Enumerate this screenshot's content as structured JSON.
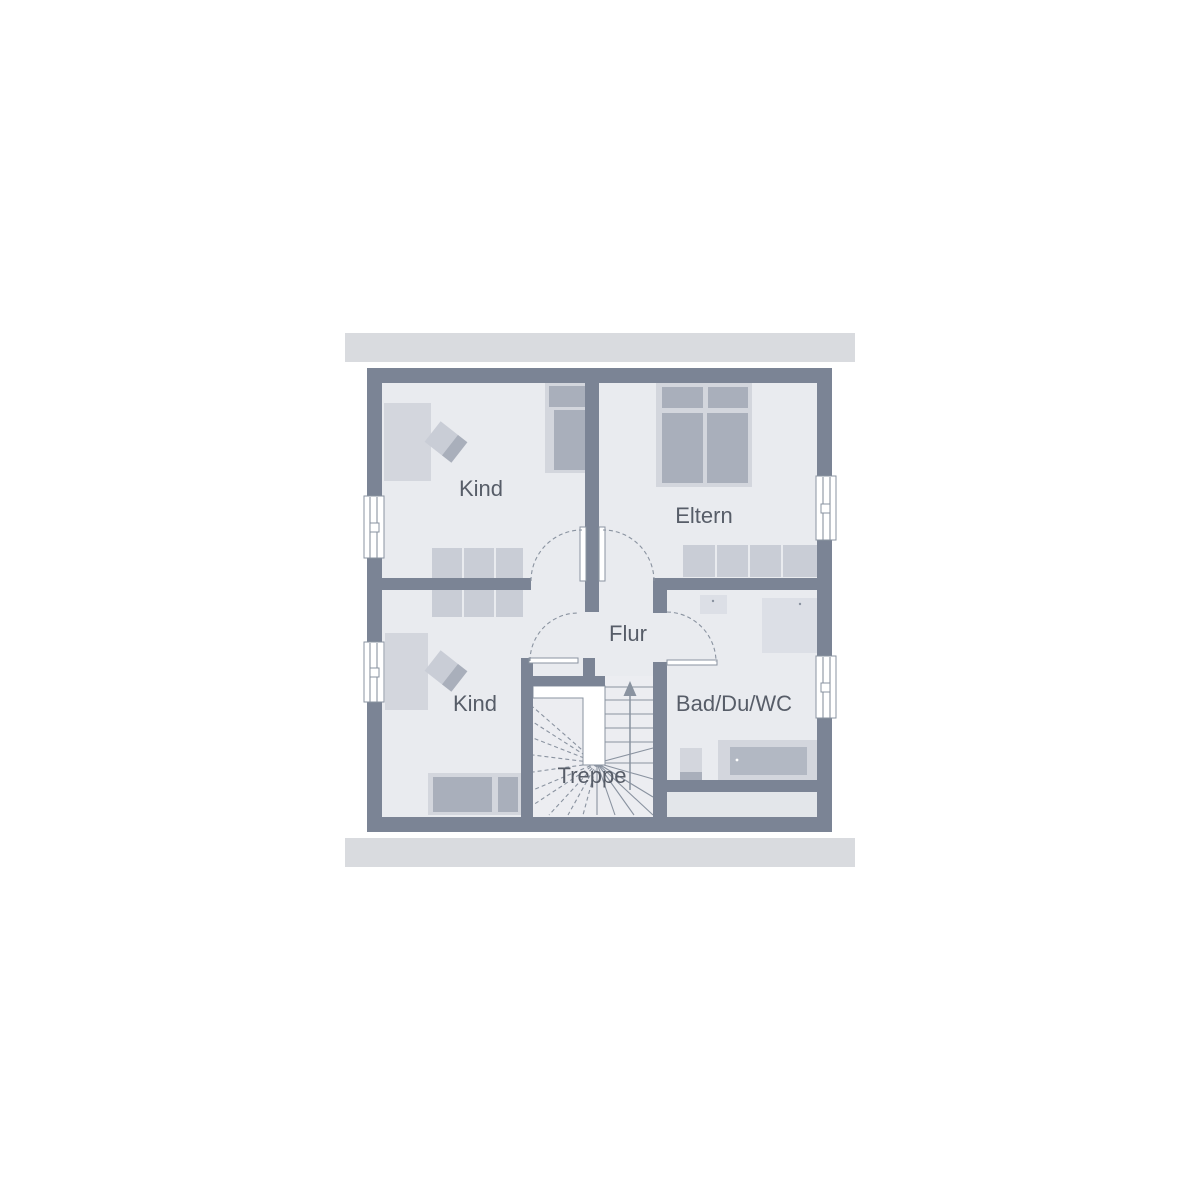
{
  "plan": {
    "type": "floor-plan",
    "rooms": {
      "kind_top": "Kind",
      "eltern": "Eltern",
      "flur": "Flur",
      "kind_bottom": "Kind",
      "bathroom": "Bad/Du/WC",
      "stairs": "Treppe"
    }
  },
  "colors": {
    "background": "#ffffff",
    "bar": "#d9dbdf",
    "wall": "#7b8495",
    "floor": "#e9ebef",
    "floor_strip": "#e3e6ea",
    "stair_floor": "#ecedf1",
    "furniture_light": "#d3d6dd",
    "furniture_medium": "#c9cdd6",
    "furniture_dark": "#a9afbb",
    "fixture": "#dcdfe6",
    "tub_inner": "#b2b8c3",
    "line": "#8a93a0",
    "text": "#575d68"
  }
}
